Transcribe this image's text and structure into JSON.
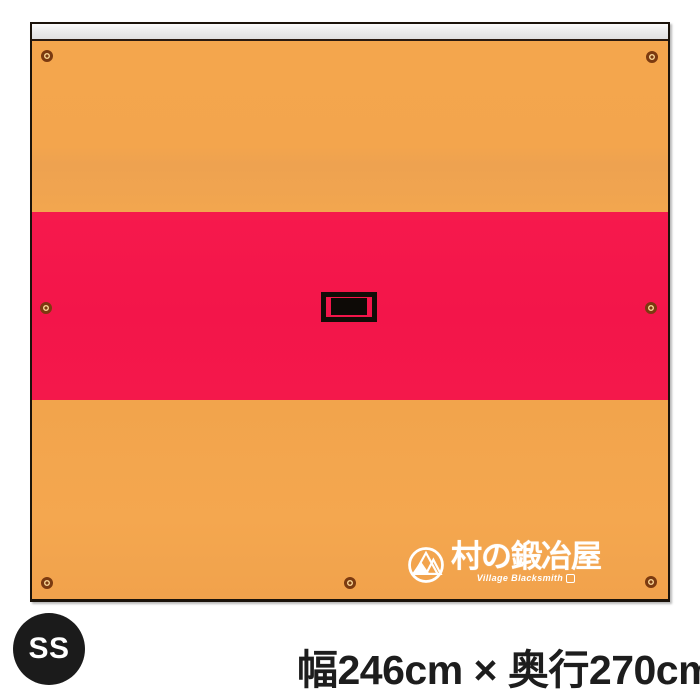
{
  "product": {
    "size_badge_label": "SS",
    "dimensions_caption": "幅246cm × 奥行270cm"
  },
  "brand": {
    "kanji": "村の鍛冶屋",
    "english": "Village Blacksmith"
  },
  "tarp": {
    "grommet_count": 7,
    "colors": {
      "body_orange": "#F3A64E",
      "stripe_red": "#F3164A",
      "border_black": "#1B130A",
      "sleeve_gray": "#E8E8E8",
      "grommet_brass": "#7B3A10",
      "badge_black": "#1B1B1B",
      "logo_white": "#FFFFFF"
    }
  }
}
